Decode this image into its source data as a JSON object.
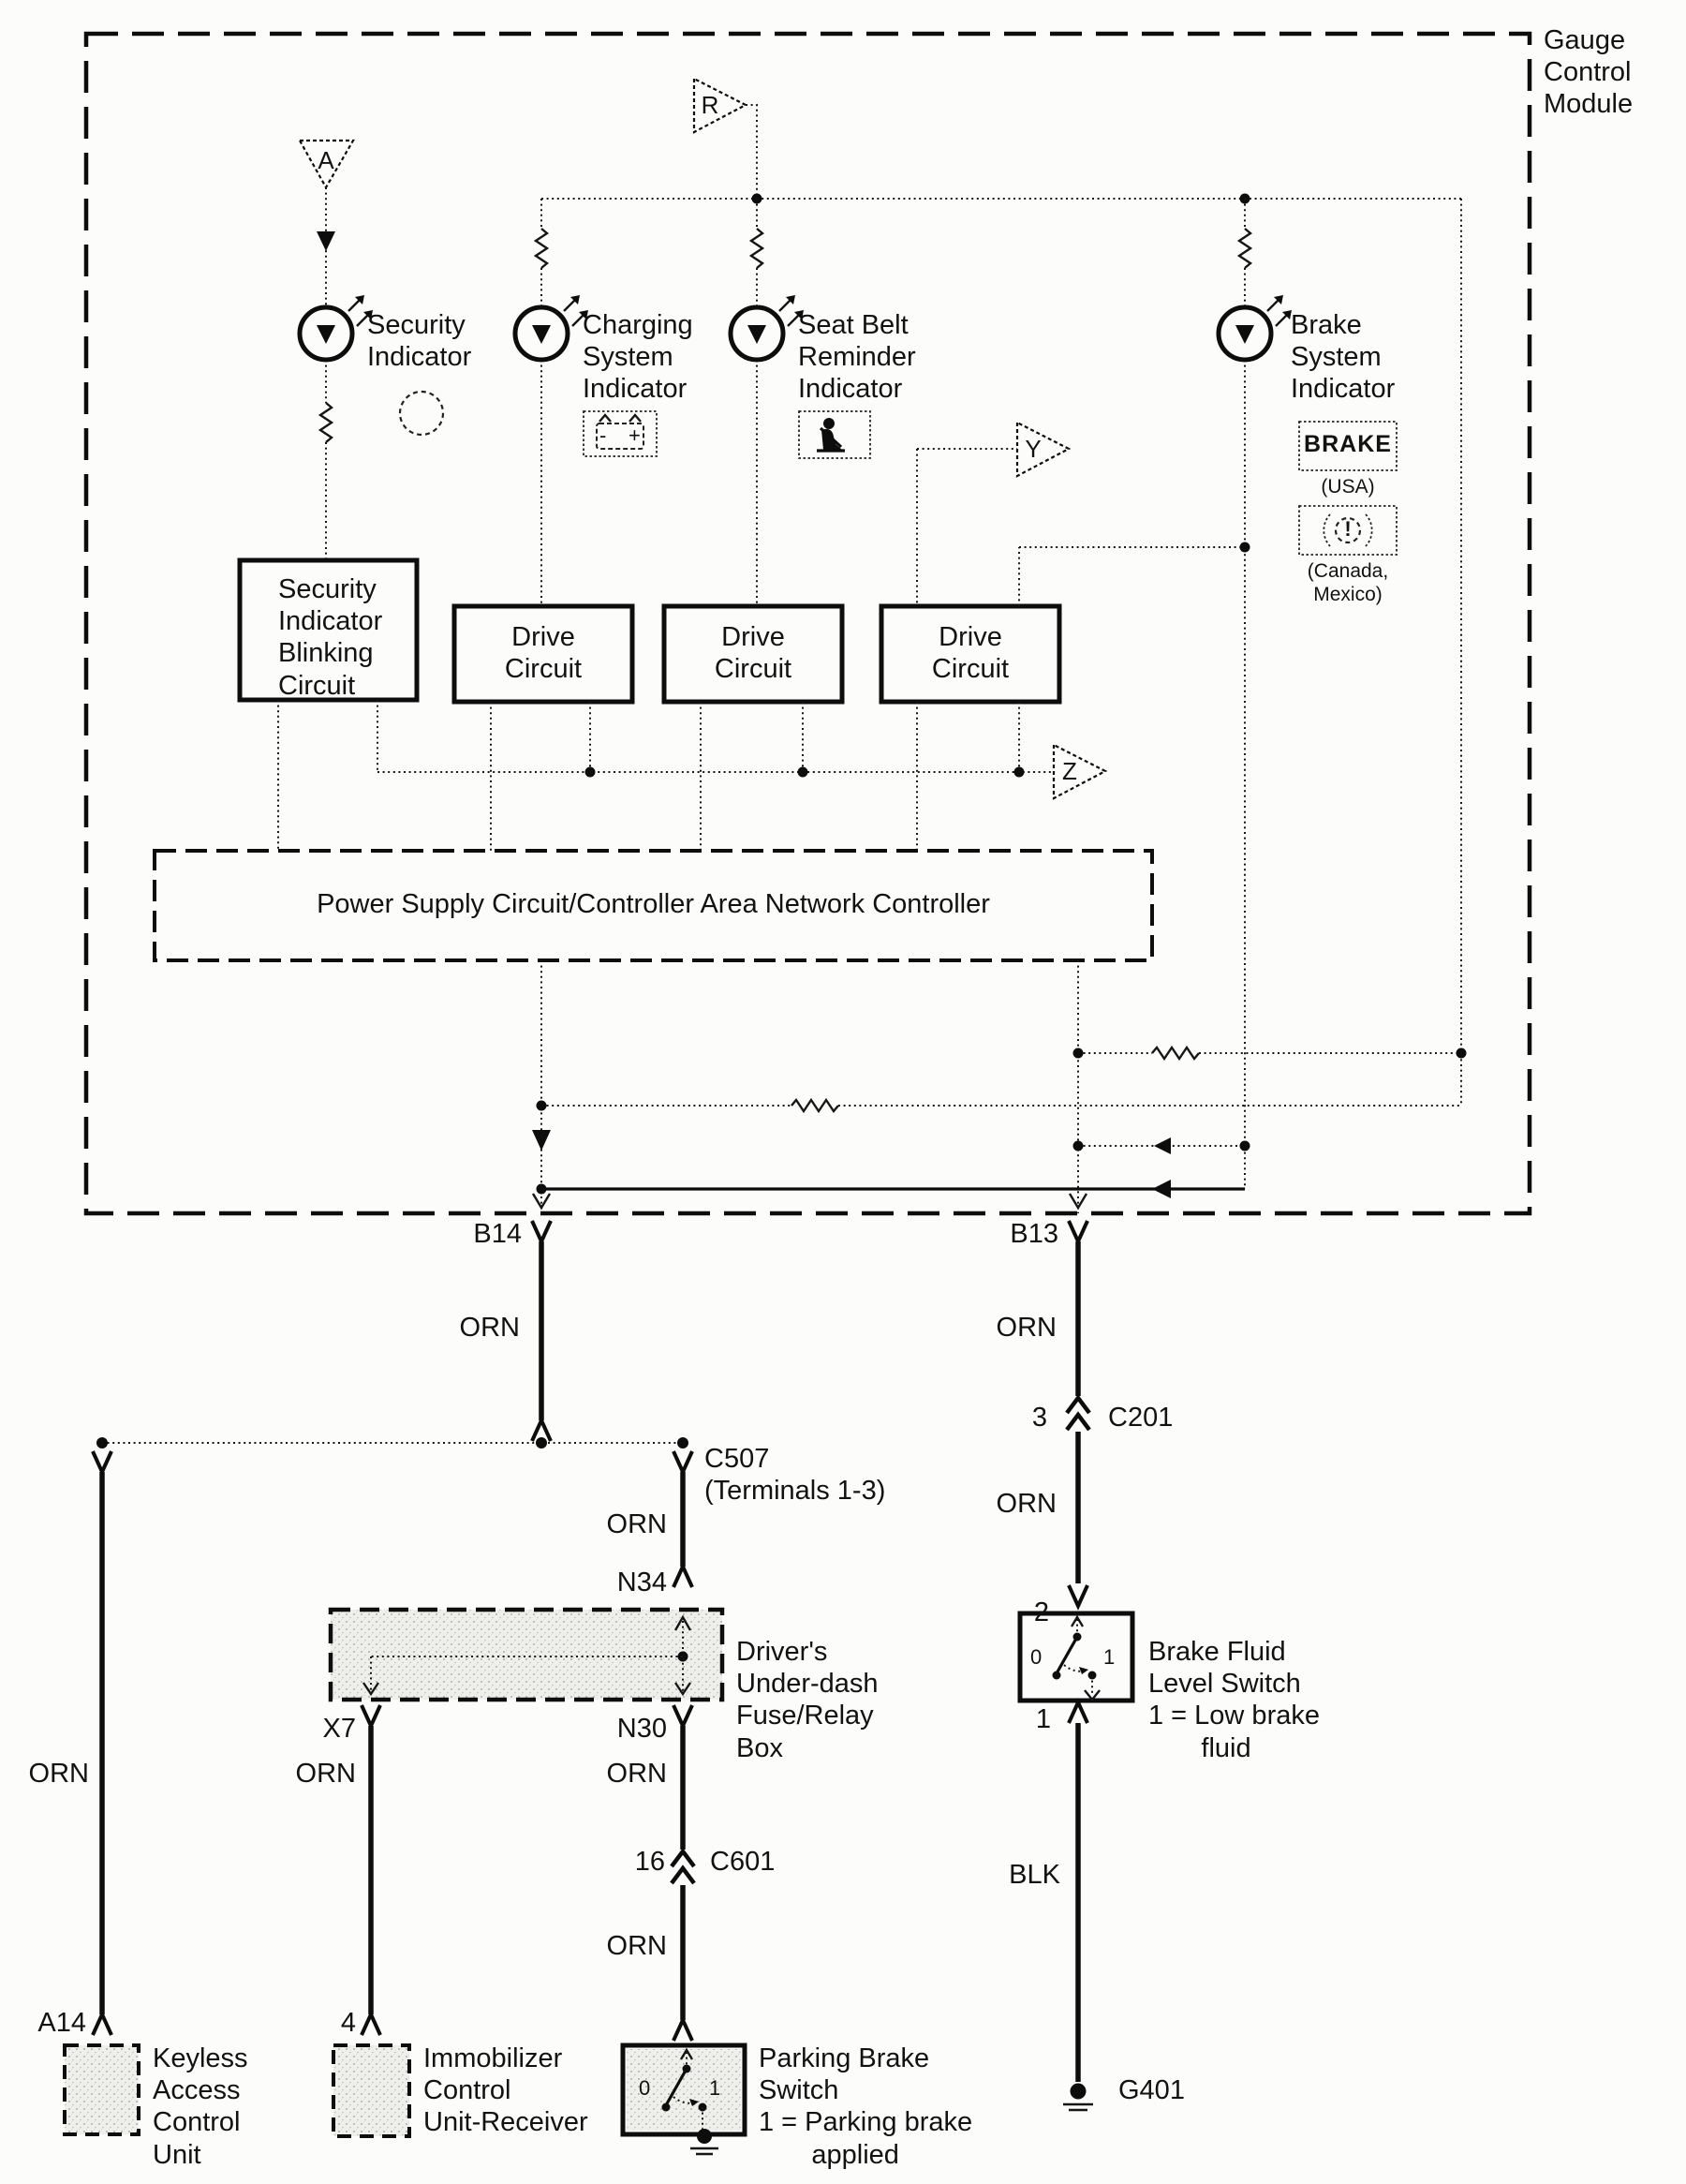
{
  "title": {
    "gauge_module": "Gauge\nControl\nModule"
  },
  "triangle_connectors": {
    "a": "A",
    "r": "R",
    "y": "Y",
    "z": "Z"
  },
  "indicator_labels": {
    "security": "Security\nIndicator",
    "charging": "Charging\nSystem\nIndicator",
    "seat_belt": "Seat Belt\nReminder\nIndicator",
    "brake": "Brake\nSystem\nIndicator"
  },
  "brake_indicator": {
    "brake_box": "BRAKE",
    "usa": "(USA)",
    "exclamation": "!",
    "canada_mexico": "(Canada,\nMexico)"
  },
  "battery_icon": {
    "minus": "-",
    "plus": "+"
  },
  "blocks": {
    "security_blinking": "Security\nIndicator\nBlinking\nCircuit",
    "drive_circuit": "Drive\nCircuit",
    "power_supply": "Power Supply Circuit/Controller Area Network Controller"
  },
  "pins": {
    "b14": "B14",
    "b13": "B13",
    "a14": "A14",
    "x7": "X7",
    "n34": "N34",
    "n30": "N30",
    "immobilizer_pin": "4",
    "c507": "C507\n(Terminals 1-3)",
    "c201_pin": "3",
    "c201": "C201",
    "c601_pin": "16",
    "c601": "C601",
    "brake_fluid_top": "2",
    "brake_fluid_bottom": "1",
    "ground": "G401"
  },
  "wire_colors": {
    "orn": "ORN",
    "blk": "BLK"
  },
  "components": {
    "fuse_relay_box": "Driver's\nUnder-dash\nFuse/Relay\nBox",
    "keyless": "Keyless\nAccess\nControl\nUnit",
    "immobilizer": "Immobilizer\nControl\nUnit-Receiver",
    "parking_brake": "Parking Brake\nSwitch\n1 = Parking brake\n       applied",
    "brake_fluid": "Brake Fluid\nLevel Switch\n1 = Low brake\n       fluid"
  },
  "switch_positions": {
    "open": "0",
    "closed": "1"
  }
}
